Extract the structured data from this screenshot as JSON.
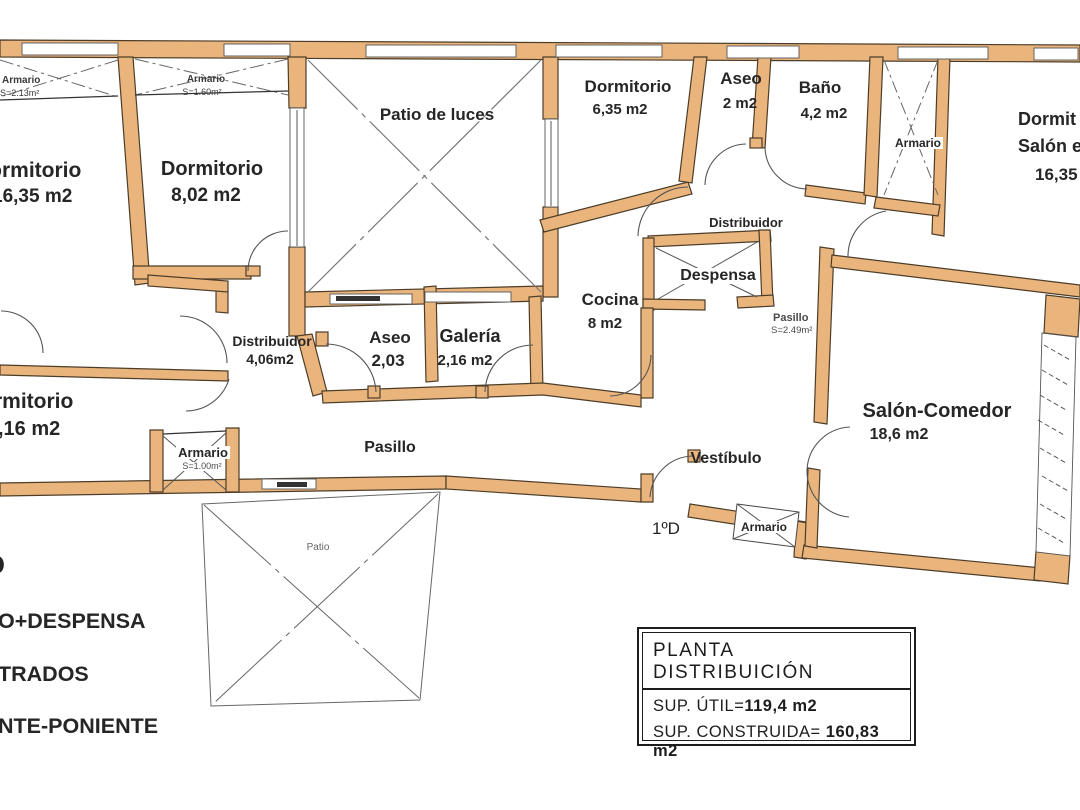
{
  "plan": {
    "rooms": {
      "armario_tl": {
        "name": "Armario",
        "area": "S=2.13m²"
      },
      "armario_tl2": {
        "name": "Armario",
        "area": "S=1.60m²"
      },
      "dormitorio_left": {
        "name": "Dormitorio",
        "area": "16,35 m2"
      },
      "dormitorio_2": {
        "name": "Dormitorio",
        "area": "8,02 m2"
      },
      "patio_luces": {
        "name": "Patio de luces"
      },
      "dormitorio_3": {
        "name": "Dormitorio",
        "area": "6,35 m2"
      },
      "aseo_top": {
        "name": "Aseo",
        "area": "2 m2"
      },
      "bano": {
        "name": "Baño",
        "area": "4,2 m2"
      },
      "armario_right": {
        "name": "Armario"
      },
      "dormitorio_salon": {
        "lines": [
          "Dormit",
          "Salón e",
          "16,35"
        ]
      },
      "distribuidor_top": {
        "name": "Distribuidor"
      },
      "despensa": {
        "name": "Despensa"
      },
      "cocina": {
        "name": "Cocina",
        "area": "8 m2"
      },
      "pasillo_pequeno": {
        "name": "Pasillo",
        "area": "S=2.49m²"
      },
      "distribuidor": {
        "name": "Distribuidor",
        "area": "4,06m2"
      },
      "aseo": {
        "name": "Aseo",
        "area": "2,03"
      },
      "galeria": {
        "name": "Galería",
        "area": "2,16 m2"
      },
      "pasillo": {
        "name": "Pasillo"
      },
      "dormitorio_inf": {
        "name": "Dormitorio",
        "area": ",16 m2"
      },
      "armario_inf": {
        "name": "Armario",
        "area": "S=1.00m²"
      },
      "vestibulo": {
        "name": "Vestíbulo"
      },
      "armario_vestibulo": {
        "name": "Armario"
      },
      "salon_comedor": {
        "name": "Salón-Comedor",
        "area": "18,6 m2"
      },
      "patio": {
        "name": "Patio"
      }
    },
    "entrance_label": "1ºD",
    "edge_text": {
      "fragment": "O",
      "line1": "O+DESPENSA",
      "line2": "TRADOS",
      "line3": "NTE-PONIENTE"
    },
    "title_block": {
      "title": "PLANTA DISTRIBUICIÓN",
      "sup_util_label": "SUP. ÚTIL=",
      "sup_util_value": "119,4 m2",
      "sup_construida_label": "SUP. CONSTRUIDA=",
      "sup_construida_value": "160,83 m2"
    },
    "colors": {
      "wall": "#EAB57D",
      "wall_outline": "#4d3d28",
      "line": "#555555",
      "text": "#262626"
    }
  }
}
